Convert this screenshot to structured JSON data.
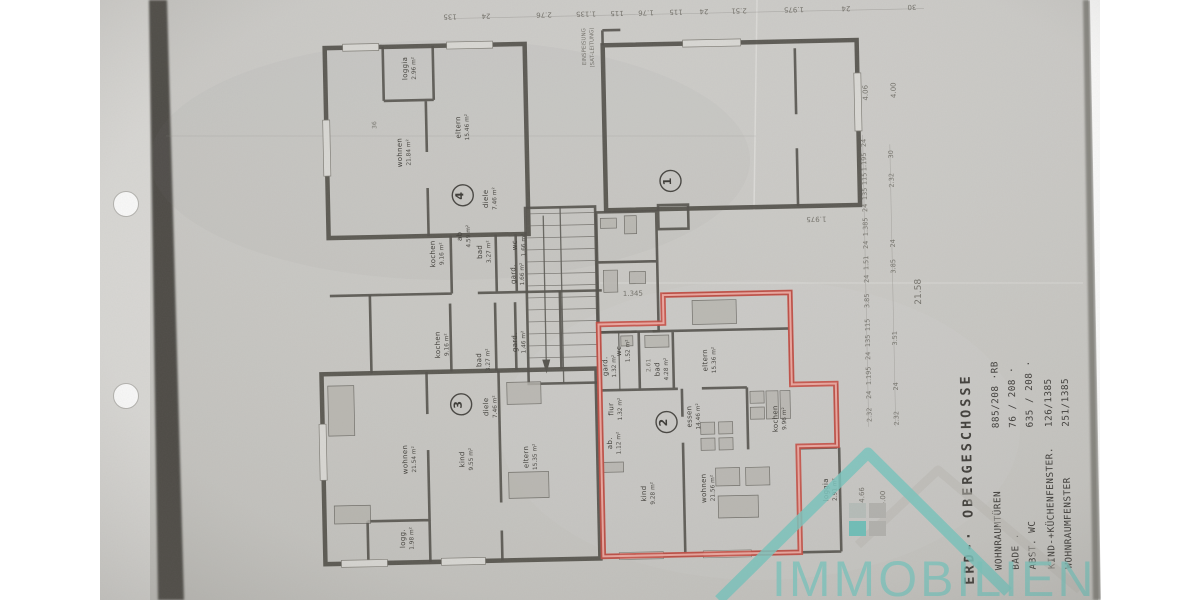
{
  "page": {
    "background": "#ffffff",
    "paper_color": "#cac9c5",
    "scan_band_color": "#454340",
    "punch_holes": 2
  },
  "watermark": {
    "brand": "IMMOBILIEN",
    "teal": "#7cc5bf",
    "gray": "#b9b7b2"
  },
  "legend": {
    "title": "ERD-· OBERGESCHOSSE",
    "rows": [
      {
        "label": "WOHNRAUMTÜREN",
        "value": "885/208 ·RB"
      },
      {
        "label": "BADE .",
        "value": "76 / 208 ·"
      },
      {
        "label": "ABST. WC",
        "value": "635 / 208 ·"
      },
      {
        "label": "KIND-+KÜCHENFENSTER.",
        "value": "126/1385"
      },
      {
        "label": "WOHNRAUMFENSTER",
        "value": "251/1385"
      }
    ]
  },
  "plan": {
    "highlight_color": "#c74b41",
    "units": [
      {
        "number": "1",
        "cx": 673,
        "cy": 182,
        "highlighted": false,
        "rooms": []
      },
      {
        "number": "2",
        "cx": 664,
        "cy": 423,
        "highlighted": true,
        "rooms": [
          {
            "n": "wc",
            "a": "1.52 m²",
            "x": 620,
            "y": 351
          },
          {
            "n": "gard.",
            "a": "1.32 m²",
            "x": 606,
            "y": 366
          },
          {
            "n": "bad",
            "a": "4.28 m²",
            "x": 658,
            "y": 370
          },
          {
            "n": "eltern",
            "a": "15.36 m²",
            "x": 706,
            "y": 362
          },
          {
            "n": "flur",
            "a": "1.32 m²",
            "x": 611,
            "y": 409
          },
          {
            "n": "ab.",
            "a": "1.12 m²",
            "x": 609,
            "y": 443
          },
          {
            "n": "essen",
            "a": "14.46 m²",
            "x": 689,
            "y": 418
          },
          {
            "n": "kochen",
            "a": "9.96 m²",
            "x": 775,
            "y": 422
          },
          {
            "n": "kind",
            "a": "9.28 m²",
            "x": 642,
            "y": 494
          },
          {
            "n": "wohnen",
            "a": "21.56 m²",
            "x": 702,
            "y": 490
          },
          {
            "n": "loggia",
            "a": "2.91 m²",
            "x": 824,
            "y": 494
          }
        ]
      },
      {
        "number": "3",
        "cx": 459,
        "cy": 401,
        "highlighted": false,
        "rooms": [
          {
            "n": "wohnen",
            "a": "21.54 m²",
            "x": 404,
            "y": 455
          },
          {
            "n": "diele",
            "a": "7.46 m²",
            "x": 486,
            "y": 404
          },
          {
            "n": "kind",
            "a": "9.55 m²",
            "x": 461,
            "y": 456
          },
          {
            "n": "eltern",
            "a": "15.35 m²",
            "x": 525,
            "y": 455
          },
          {
            "n": "logg.",
            "a": "1.98 m²",
            "x": 400,
            "y": 534
          },
          {
            "n": "kochen",
            "a": "9.16 m²",
            "x": 439,
            "y": 341
          },
          {
            "n": "bad",
            "a": "3.27 m²",
            "x": 480,
            "y": 357
          },
          {
            "n": "gard.",
            "a": "1.46 m²",
            "x": 516,
            "y": 340
          }
        ]
      },
      {
        "number": "4",
        "cx": 465,
        "cy": 192,
        "highlighted": false,
        "rooms": [
          {
            "n": "loggia",
            "a": "2.96 m²",
            "x": 412,
            "y": 64
          },
          {
            "n": "wohnen",
            "a": "21.84 m²",
            "x": 405,
            "y": 148
          },
          {
            "n": "eltern",
            "a": "15.46 m²",
            "x": 464,
            "y": 124
          },
          {
            "n": "diele",
            "a": "7.46 m²",
            "x": 490,
            "y": 196
          },
          {
            "n": "kochen",
            "a": "9.16 m²",
            "x": 436,
            "y": 250
          },
          {
            "n": "ab",
            "a": "4.59 m²",
            "x": 463,
            "y": 233
          },
          {
            "n": "bad",
            "a": "3.27 m²",
            "x": 483,
            "y": 249
          },
          {
            "n": "wc",
            "a": "1.66 m²",
            "x": 518,
            "y": 243
          },
          {
            "n": "gard.",
            "a": "1.66 m²",
            "x": 516,
            "y": 272
          }
        ]
      }
    ],
    "annotations": [
      {
        "t": "EINSPEISUNG",
        "x": 591,
        "y": 46,
        "r": -90,
        "s": 5.5
      },
      {
        "t": "(SAT-LEITUNG)",
        "x": 599,
        "y": 47,
        "r": -90,
        "s": 5.5
      },
      {
        "t": "1.345",
        "x": 633,
        "y": 296,
        "r": 0,
        "s": 7
      },
      {
        "t": "2.61",
        "x": 649,
        "y": 366,
        "r": -90,
        "s": 6
      },
      {
        "t": "1.975",
        "x": 818,
        "y": 221,
        "r": 180,
        "s": 7
      },
      {
        "t": "21.58",
        "x": 921,
        "y": 298,
        "r": -90,
        "s": 9
      },
      {
        "t": "4.06",
        "x": 872,
        "y": 98,
        "r": -90,
        "s": 7
      },
      {
        "t": "4.00",
        "x": 900,
        "y": 96,
        "r": -90,
        "s": 7
      },
      {
        "t": "4.66",
        "x": 860,
        "y": 500,
        "r": -90,
        "s": 7
      },
      {
        "t": "4.00",
        "x": 881,
        "y": 504,
        "r": -90,
        "s": 7
      },
      {
        "t": "36",
        "x": 380,
        "y": 120,
        "r": -90,
        "s": 6
      }
    ],
    "dim_top": [
      {
        "t": "135",
        "x": 456
      },
      {
        "t": "24",
        "x": 492
      },
      {
        "t": "2.76",
        "x": 550
      },
      {
        "t": "1.135",
        "x": 592
      },
      {
        "t": "115",
        "x": 623
      },
      {
        "t": "1.76",
        "x": 652
      },
      {
        "t": "115",
        "x": 682
      },
      {
        "t": "24",
        "x": 710
      },
      {
        "t": "2.51",
        "x": 745
      },
      {
        "t": "1.975",
        "x": 800
      },
      {
        "t": "24",
        "x": 852
      },
      {
        "t": "30",
        "x": 918
      }
    ],
    "dim_right_inner": [
      {
        "t": "24",
        "y": 148
      },
      {
        "t": "1.195",
        "y": 167
      },
      {
        "t": "115",
        "y": 184
      },
      {
        "t": "135",
        "y": 199
      },
      {
        "t": "24",
        "y": 213
      },
      {
        "t": "1.385",
        "y": 232
      },
      {
        "t": "24",
        "y": 250
      },
      {
        "t": "1.51",
        "y": 268
      },
      {
        "t": "24",
        "y": 284
      },
      {
        "t": "3.85",
        "y": 306
      },
      {
        "t": "115",
        "y": 330
      },
      {
        "t": "135",
        "y": 346
      },
      {
        "t": "24",
        "y": 361
      },
      {
        "t": "1.195",
        "y": 381
      },
      {
        "t": "24",
        "y": 400
      },
      {
        "t": "2.32",
        "y": 420
      }
    ],
    "dim_right_outer": [
      {
        "t": "30",
        "y": 160
      },
      {
        "t": "2.32",
        "y": 186
      },
      {
        "t": "24",
        "y": 249
      },
      {
        "t": "3.85",
        "y": 272
      },
      {
        "t": "3.51",
        "y": 344
      },
      {
        "t": "24",
        "y": 392
      },
      {
        "t": "2.32",
        "y": 424
      }
    ]
  }
}
